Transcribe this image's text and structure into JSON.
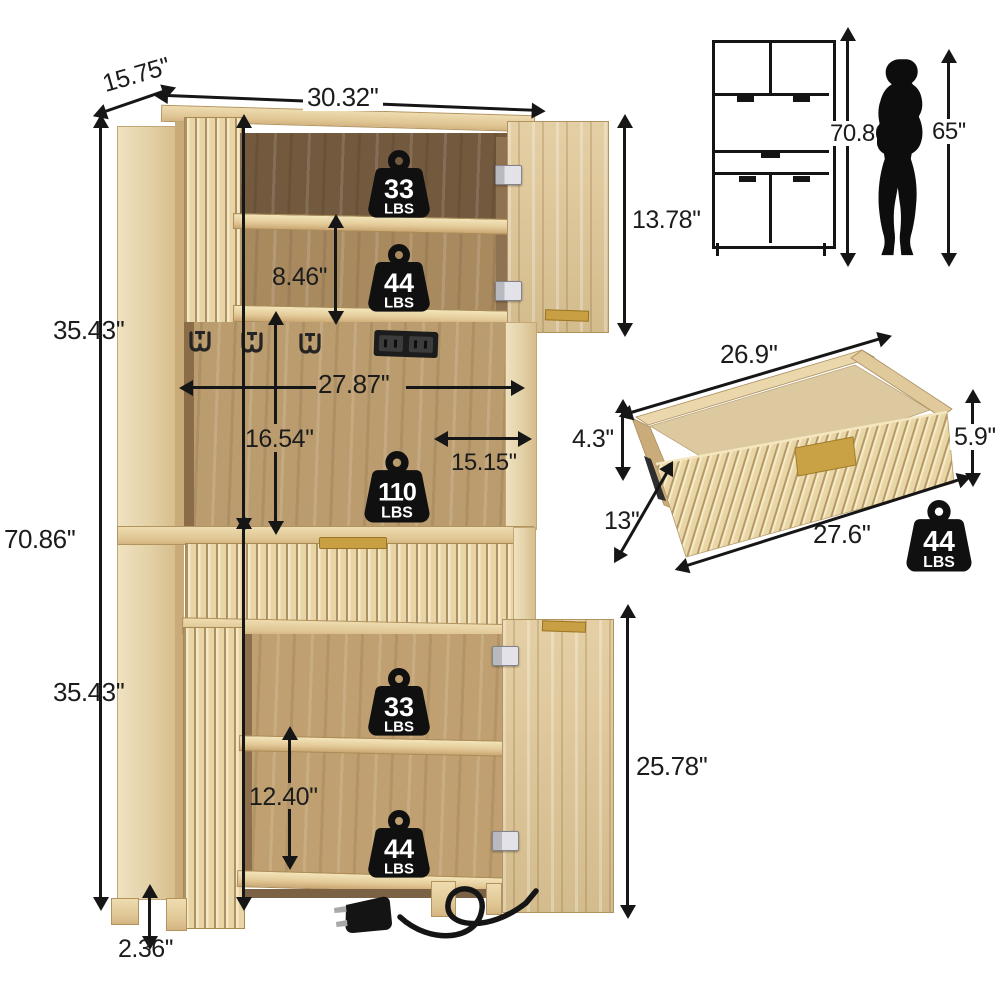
{
  "units": {
    "lbs": "LBS"
  },
  "main_unit": {
    "depth": "15.75''",
    "width": "30.32''",
    "upper_height": "35.43''",
    "total_height": "70.86''",
    "lower_height": "35.43''",
    "leg_height": "2.36''",
    "top_door_height": "13.78''",
    "shelf_spacing": "8.46''",
    "interior_width": "27.87''",
    "middle_height": "16.54''",
    "side_depth": "15.15''",
    "bottom_shelf_height": "12.40''",
    "bottom_door_height": "25.78''",
    "weights": {
      "top_shelf": "33",
      "upper_shelf": "44",
      "middle": "110",
      "bottom_shelf": "33",
      "bottom_lower": "44"
    }
  },
  "front_view": {
    "height": "70.86''",
    "person_height": "65''"
  },
  "drawer_view": {
    "inner_length": "26.9''",
    "inner_height": "4.3''",
    "outer_height": "5.9''",
    "depth": "13''",
    "outer_length": "27.6''",
    "weight": "44"
  }
}
